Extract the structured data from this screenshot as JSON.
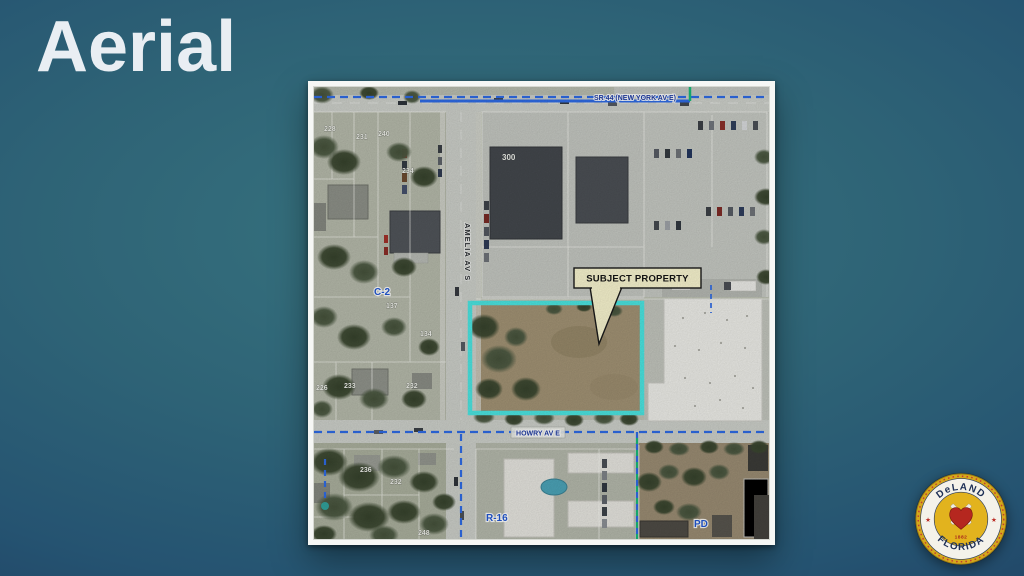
{
  "slide": {
    "title": "Aerial"
  },
  "map": {
    "streets": {
      "top": "SR 44 (NEW YORK AV E)",
      "vertical": "AMELIA AV S",
      "bottom": "HOWRY AV E"
    },
    "zoning": {
      "c2": "C-2",
      "r16": "R-16",
      "pd": "PD"
    },
    "callout": "SUBJECT PROPERTY",
    "building_number": "300",
    "parcels": [
      {
        "label": "228"
      },
      {
        "label": "231"
      },
      {
        "label": "240"
      },
      {
        "label": "234"
      },
      {
        "label": "137"
      },
      {
        "label": "134"
      },
      {
        "label": "226"
      },
      {
        "label": "233"
      },
      {
        "label": "232"
      },
      {
        "label": "236"
      },
      {
        "label": "232"
      },
      {
        "label": "248"
      }
    ],
    "colors": {
      "subject_outline": "#4BE3DF",
      "zoning_boundary": "#2E6AE3",
      "zoning_boundary_alt": "#17B878",
      "zoning_label": "#2257D0",
      "callout_bg": "#F6F2CD"
    }
  },
  "seal": {
    "top": "DeLAND",
    "bottom": "FLORIDA",
    "year": "1882"
  }
}
